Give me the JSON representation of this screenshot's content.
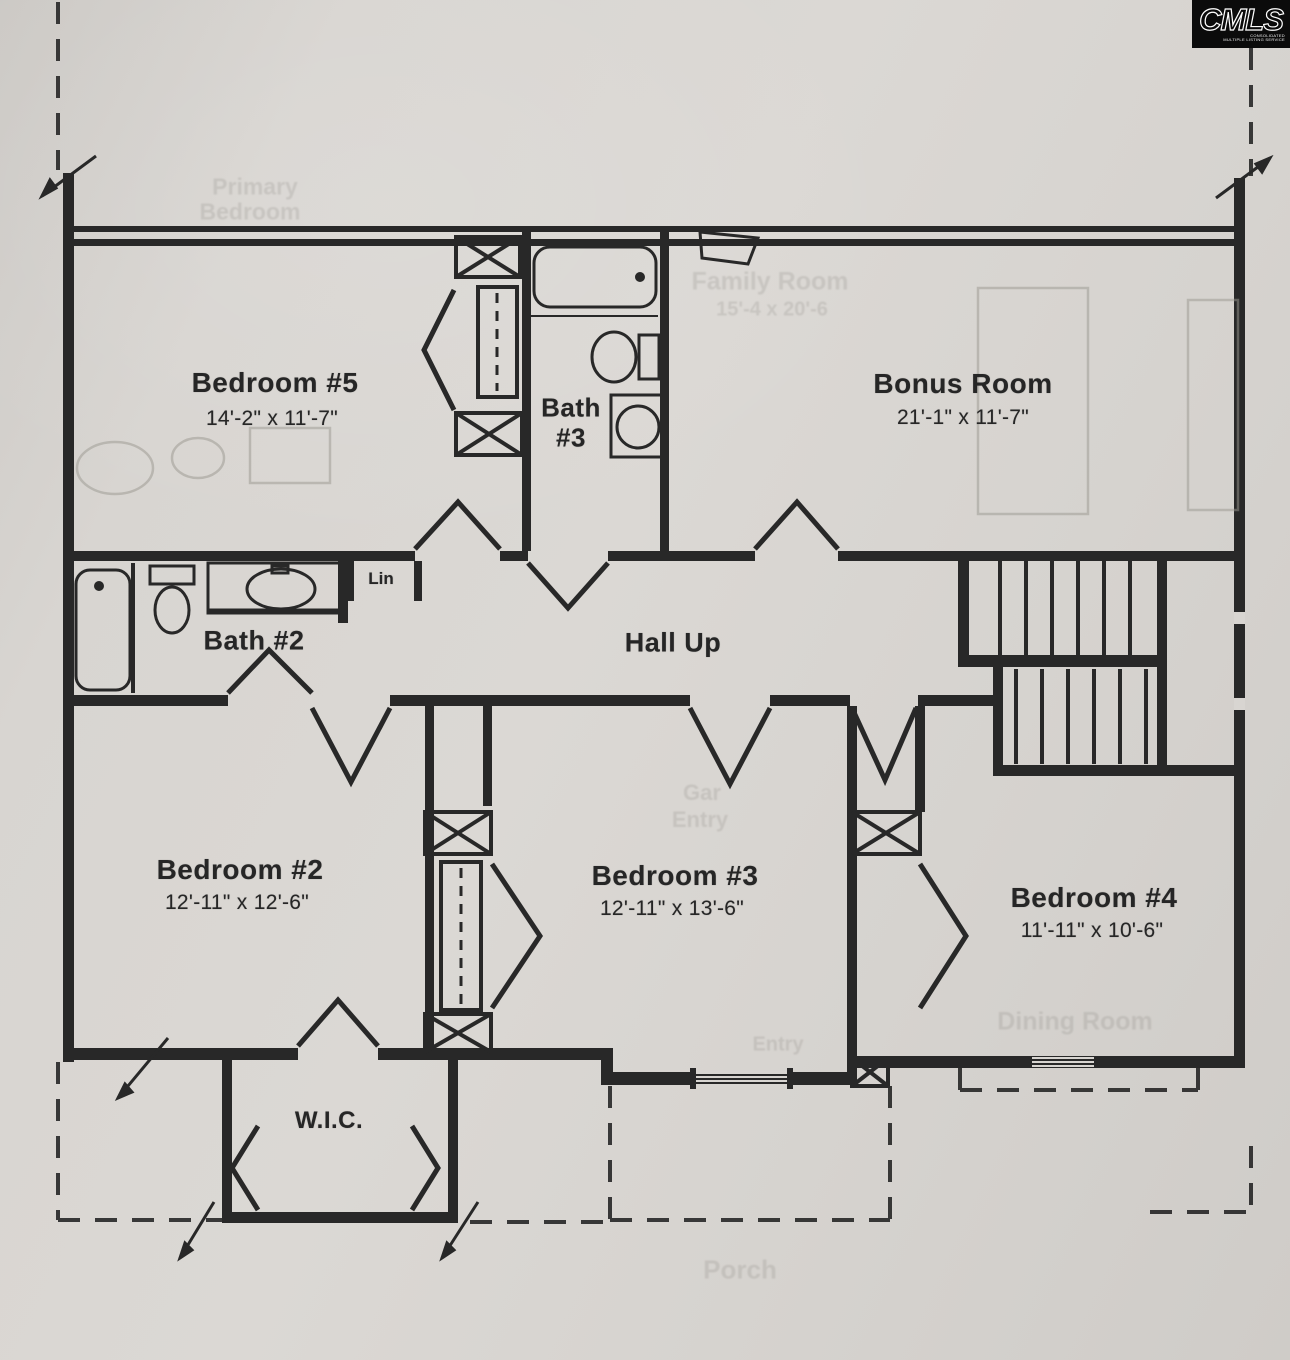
{
  "logo": {
    "name": "CMLS",
    "subtitle1": "CONSOLIDATED",
    "subtitle2": "MULTIPLE LISTING SERVICE"
  },
  "rooms": {
    "bedroom5": {
      "name": "Bedroom #5",
      "dims": "14'-2\" x 11'-7\""
    },
    "bath3": {
      "name_line1": "Bath",
      "name_line2": "#3"
    },
    "bonus": {
      "name": "Bonus Room",
      "dims": "21'-1\" x 11'-7\""
    },
    "bath2": {
      "name": "Bath #2"
    },
    "linen": {
      "name": "Lin"
    },
    "hall": {
      "name": "Hall Up"
    },
    "bedroom2": {
      "name": "Bedroom #2",
      "dims": "12'-11\" x 12'-6\""
    },
    "bedroom3": {
      "name": "Bedroom #3",
      "dims": "12'-11\" x 13'-6\""
    },
    "bedroom4": {
      "name": "Bedroom #4",
      "dims": "11'-11\" x 10'-6\""
    },
    "wic": {
      "name": "W.I.C."
    }
  },
  "ghost_labels": {
    "primary_line1": "Primary",
    "primary_line2": "Bedroom",
    "family_room": "Family Room",
    "family_room_dims": "15'-4 x 20'-6",
    "gar": "Gar",
    "gar_entry": "Entry",
    "entry": "Entry",
    "dining": "Dining Room",
    "porch": "Porch"
  },
  "colors": {
    "paper": "#d8d5d1",
    "ink": "#282828",
    "ghost": "#9a978f"
  }
}
